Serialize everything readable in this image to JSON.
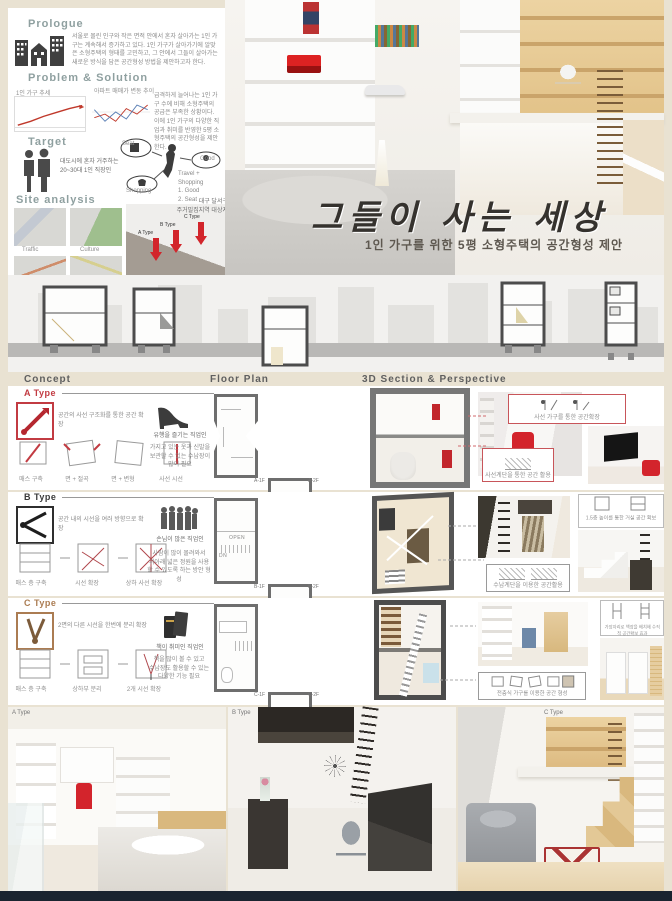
{
  "prologue": {
    "title": "Prologue",
    "text": "서울로 몰린 인구와 작은 면적 안에서 혼자 살아가는 1인 가구는 계속해서 증가하고 있다. 1인 가구가 살아가기에 알맞은 소형주택의 형태를 고민하고, 그 안에서 그들이 살아가는 새로운 방식을 담은 공간형성 방법을 제안하고자 한다."
  },
  "problem_solution": {
    "title": "Problem & Solution",
    "chart1_caption": "1인 가구 추세",
    "chart2_caption": "아파트 매매가 변동 추이",
    "note": "급격하게 늘어나는 1인 가구 수에 비해 소형주택의 공급은 부족한 상황이다. 이에 1인 가구의 다양한 직업과 취미를 반영한 5평 소형주택의 공간형성을 제안한다."
  },
  "chart_data": [
    {
      "type": "line",
      "title": "1인 가구 추세",
      "series": [
        {
          "name": "1인 가구",
          "values": [
            10,
            14,
            19,
            23,
            27,
            30
          ]
        }
      ],
      "legend_position": "none",
      "grid": false
    },
    {
      "type": "line",
      "title": "아파트 매매가 변동 추이",
      "series": [
        {
          "name": "매매",
          "values": [
            20,
            24,
            16,
            30,
            24,
            34
          ]
        },
        {
          "name": "전세",
          "values": [
            28,
            18,
            26,
            20,
            32,
            28
          ]
        }
      ],
      "legend_position": "none",
      "grid": false
    }
  ],
  "target": {
    "title": "Target",
    "desc": "대도시에 혼자 거주하는\n20~30대 1인 직장인",
    "node_travel": "Travel",
    "node_seat": "Seat",
    "node_good": "Good",
    "node_shopping": "Shopping",
    "note": "Travel + Shopping\n1. Good\n2. Seat"
  },
  "site_analysis": {
    "title": "Site analysis",
    "maps": [
      "Traffic",
      "Culture",
      "Active area",
      "Commerce"
    ],
    "site_note": "대구 달서구\n주거밀집지역 대상지",
    "arrow_labels": [
      "A Type",
      "B Type",
      "C Type"
    ]
  },
  "title_block": {
    "main": "그들이 사는 세상",
    "sub": "1인 가구를 위한 5평 소형주택의 공간형성 제안"
  },
  "columns": {
    "concept": "Concept",
    "floor_plan": "Floor Plan",
    "section": "3D Section & Perspective"
  },
  "plan_words": {
    "open": "OPEN",
    "up": "UP",
    "dn": "DN"
  },
  "types": [
    {
      "label": "A Type",
      "color": "#c23b42",
      "concept_note": "공간의 사선 구조화를 통한 공간 확장",
      "steps": [
        "매스 구축",
        "면 + 절곡",
        "면 + 변형",
        "사선 시선"
      ],
      "persona_icon": "high-heel",
      "persona_name": "유행을 즐기는 직업인",
      "persona_desc": "가지고 있는 옷과 신발을\n보관할 수 있는 수납장이\n많이 필요",
      "plans": [
        "A-1F",
        "A-2F"
      ],
      "callout1": "사선 가구를 통한 공간확장",
      "callout2": "사선계단을 통한 공간 활용"
    },
    {
      "label": "B Type",
      "color": "#3a3a3a",
      "concept_note": "공간 내의 시선을 여러 방향으로 확장",
      "steps": [
        "매스 층 구축",
        "시선 확장",
        "상하 사선 확장"
      ],
      "persona_icon": "crowd",
      "persona_name": "손님이 많은 직업인",
      "persona_desc": "사람이 많이 몰려와서\n위아래 넓은 정원을 사용\n할 수 있도록 하는 방안 형성",
      "plans": [
        "B-1F",
        "B-2F"
      ],
      "callout1": "1.5층 높이를 통한 거실 공간 확보",
      "callout2": "수납계단을 이용한 공간활용"
    },
    {
      "label": "C Type",
      "color": "#ab7c52",
      "concept_note": "2면의 다른 시선을 한번에 분리 확장",
      "steps": [
        "매스 층 구축",
        "상하부 분리",
        "2개 시선 확장"
      ],
      "persona_icon": "books",
      "persona_name": "책이 취미인 직업인",
      "persona_desc": "책을 많이 볼 수 있고\n수납장도 활용할 수 있는\n다양한 기능 필요",
      "plans": [
        "C-1F",
        "C-2F"
      ],
      "callout1": "가장자리로 책장을 배치해 수직적 공간확보 효과",
      "callout2": "전층식 가구를 이용한 공간 형성"
    }
  ],
  "bottom_renders": [
    {
      "label": "A Type"
    },
    {
      "label": "B Type"
    },
    {
      "label": "C Type"
    }
  ]
}
